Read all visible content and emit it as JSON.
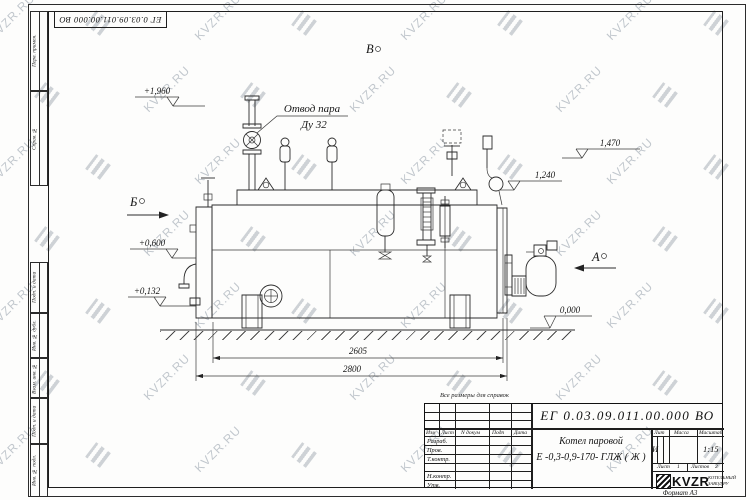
{
  "watermark": {
    "text": "KVZR.RU"
  },
  "frame": {
    "top_designation": "ЕГ 0.03.09.011.00.000  ВО",
    "left_boxes": [
      "Перв. примен.",
      "Справ. №",
      "Подп. и дата",
      "Инв. № дубл.",
      "Взам. инв. №",
      "Подп. и дата",
      "Инв. № подл."
    ],
    "format_label": "Формат А3"
  },
  "drawing": {
    "callout": {
      "line1": "Отвод пара",
      "line2": "Ду 32"
    },
    "views": {
      "b": "Б",
      "v": "В",
      "a": "А"
    },
    "elevations": {
      "m1960": "+1,960",
      "m0600": "+0,600",
      "m0132": "+0,132",
      "m1470": "1,470",
      "m1240": "1,240",
      "m0000": "0,000"
    },
    "dims": {
      "inner": "2605",
      "overall": "2800"
    },
    "note": "Все размеры для справок"
  },
  "title_block": {
    "designation": "ЕГ 0.03.09.011.00.000  ВО",
    "product_name_line1": "Котел паровой",
    "product_name_line2": "Е -0,3-0,9-170- ГЛЖ ( Ж )",
    "header_cols": [
      "Изм",
      "Лист",
      "N докум",
      "Подп",
      "Дата"
    ],
    "staff_rows": [
      "Разраб.",
      "Пров.",
      "Т.контр.",
      "",
      "Н.контр.",
      "Утв."
    ],
    "lit_label": "Лит",
    "lit_value": "И",
    "mass_label": "Масса",
    "scale_label": "Масштаб",
    "scale_value": "1:15",
    "sheet_label": "Лист",
    "sheet_value": "1",
    "sheets_label": "Листов",
    "sheets_value": "2",
    "logo_text": "KVZR",
    "logo_caption_line1": "КОТЕЛЬНЫЙ",
    "logo_caption_line2": "ЗАВОД.РУ"
  }
}
